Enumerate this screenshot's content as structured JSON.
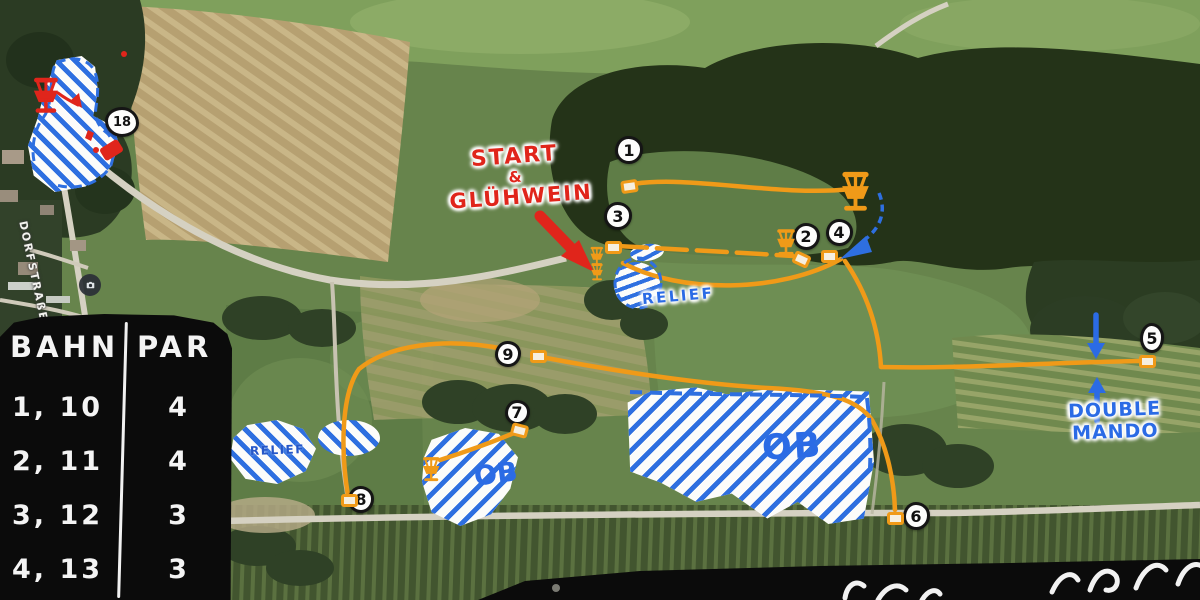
{
  "annotations": {
    "start": {
      "line1": "START",
      "line2": "&",
      "line3": "GLÜHWEIN"
    },
    "relief_center": "RELIEF",
    "relief_left": "RELIEF",
    "ob_left": "OB",
    "ob_big": "OB",
    "double_mando": {
      "line1": "DOUBLE",
      "line2": "MANDO"
    },
    "street": "DORFSTRAßE"
  },
  "score_table": {
    "col1_header": "BAHN",
    "col2_header": "PAR",
    "rows": [
      {
        "bahn": "1, 10",
        "par": "4"
      },
      {
        "bahn": "2, 11",
        "par": "4"
      },
      {
        "bahn": "3, 12",
        "par": "3"
      },
      {
        "bahn": "4, 13",
        "par": "3"
      }
    ]
  },
  "map": {
    "hole_markers": [
      {
        "num": "1",
        "x": 629,
        "y": 150,
        "w": 28,
        "h": 28
      },
      {
        "num": "3",
        "x": 618,
        "y": 216,
        "w": 28,
        "h": 28
      },
      {
        "num": "2",
        "x": 806,
        "y": 236,
        "w": 27,
        "h": 27
      },
      {
        "num": "4",
        "x": 839,
        "y": 232,
        "w": 27,
        "h": 27
      },
      {
        "num": "5",
        "x": 1152,
        "y": 338,
        "w": 24,
        "h": 30
      },
      {
        "num": "6",
        "x": 916,
        "y": 516,
        "w": 27,
        "h": 28
      },
      {
        "num": "7",
        "x": 517,
        "y": 412,
        "w": 25,
        "h": 25
      },
      {
        "num": "8",
        "x": 361,
        "y": 499,
        "w": 26,
        "h": 27
      },
      {
        "num": "9",
        "x": 508,
        "y": 354,
        "w": 26,
        "h": 26
      },
      {
        "num": "18",
        "x": 122,
        "y": 122,
        "w": 34,
        "h": 30
      }
    ],
    "tee_pads": [
      {
        "hole": "1",
        "x": 629,
        "y": 186,
        "rot": -8
      },
      {
        "hole": "3",
        "x": 613,
        "y": 247,
        "rot": 0
      },
      {
        "hole": "2",
        "x": 801,
        "y": 259,
        "rot": 25
      },
      {
        "hole": "4",
        "x": 829,
        "y": 256,
        "rot": 0
      },
      {
        "hole": "5",
        "x": 1147,
        "y": 361,
        "rot": 0
      },
      {
        "hole": "6",
        "x": 895,
        "y": 518,
        "rot": 0
      },
      {
        "hole": "7",
        "x": 519,
        "y": 430,
        "rot": 15
      },
      {
        "hole": "8",
        "x": 349,
        "y": 500,
        "rot": 0
      },
      {
        "hole": "9",
        "x": 538,
        "y": 356,
        "rot": 0
      }
    ],
    "baskets": [
      {
        "name": "basket-hole-18",
        "x": 46,
        "y": 76,
        "h": 38,
        "color": "#e0251b"
      },
      {
        "name": "basket-top-right",
        "x": 855,
        "y": 170,
        "h": 42,
        "color": "#f09a18"
      },
      {
        "name": "basket-near-hole-2",
        "x": 786,
        "y": 228,
        "h": 28,
        "color": "#f09a18"
      },
      {
        "name": "basket-near-ob-left",
        "x": 431,
        "y": 456,
        "h": 26,
        "color": "#f09a18"
      },
      {
        "name": "basket-start-a",
        "x": 597,
        "y": 246,
        "h": 20,
        "color": "#f09a18"
      },
      {
        "name": "basket-start-b",
        "x": 597,
        "y": 263,
        "h": 18,
        "color": "#f09a18"
      }
    ]
  },
  "colors": {
    "route_orange": "#f09a18",
    "ob_blue": "#2e6fe0",
    "label_blue": "#2b6be5",
    "marker_red": "#e0251b",
    "panel_black": "#0b0b0b"
  }
}
